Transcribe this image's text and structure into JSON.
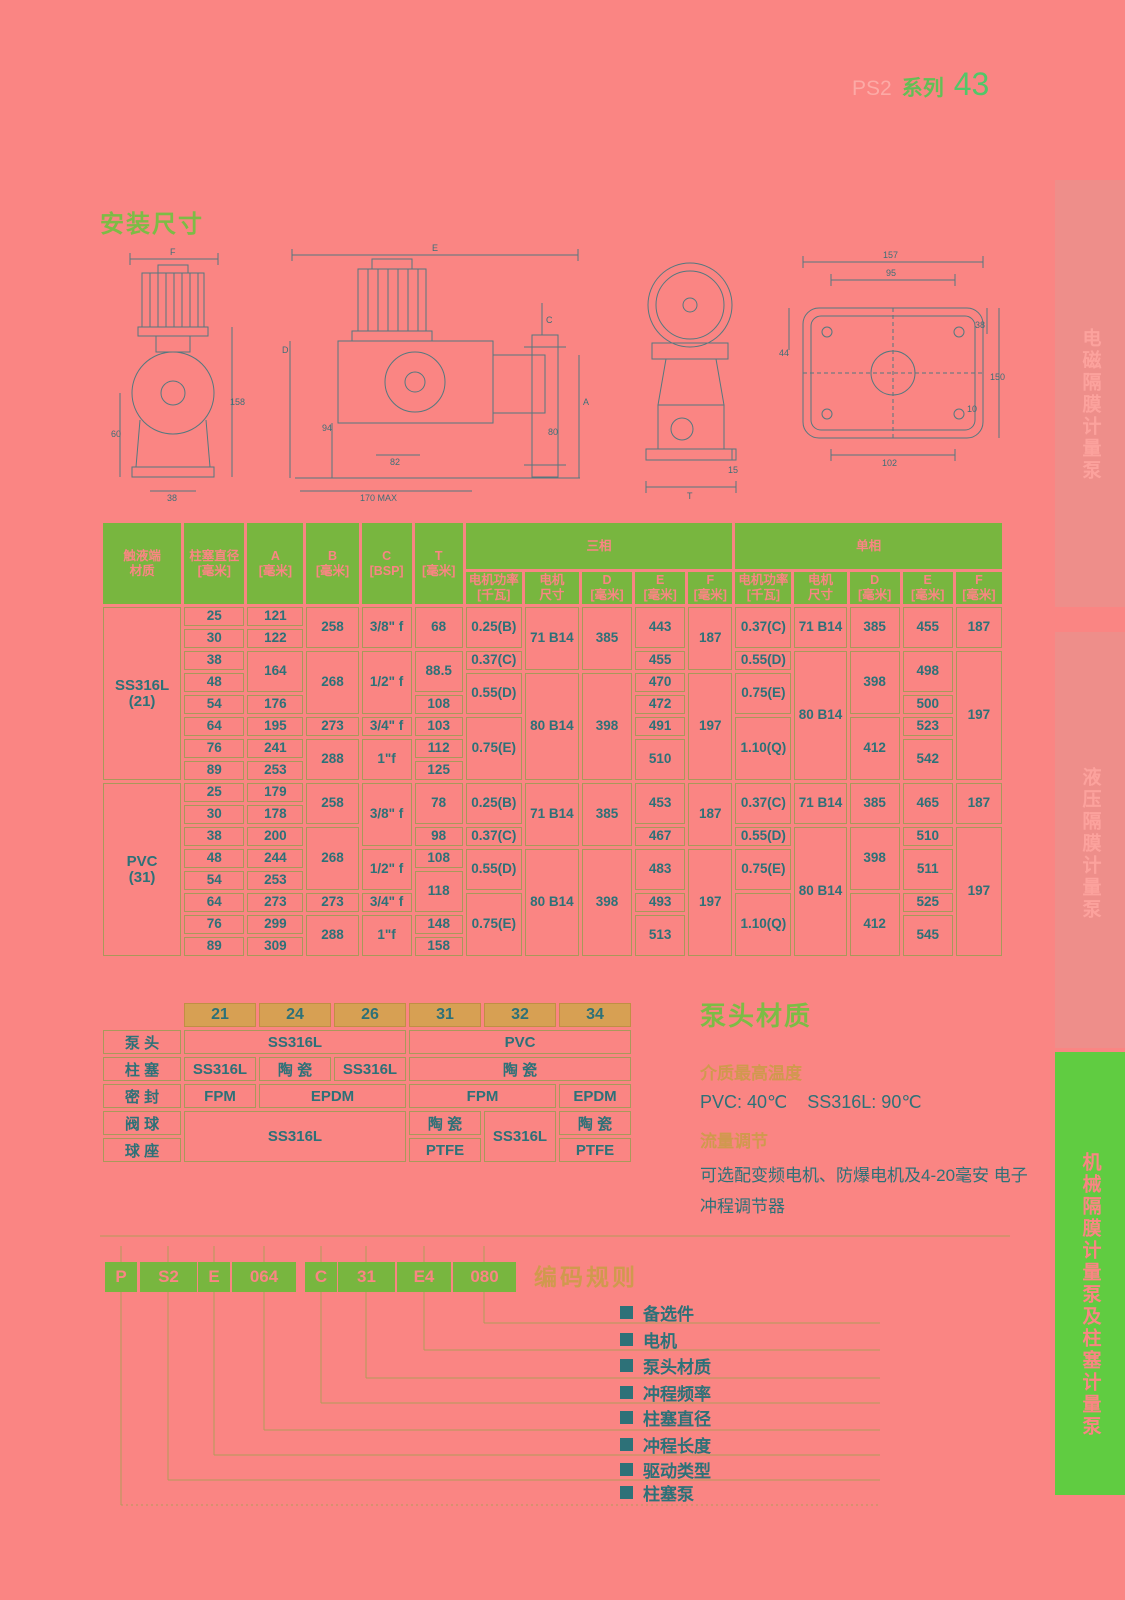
{
  "header": {
    "series_prefix": "PS2",
    "series_label": "系列",
    "page_number": "43"
  },
  "install": {
    "title": "安装尺寸"
  },
  "drawings": {
    "d1": {
      "f": "F",
      "n60": "60",
      "n158": "158",
      "n38": "38"
    },
    "d2": {
      "e": "E",
      "c": "C",
      "d": "D",
      "n94": "94",
      "n82": "82",
      "n170": "170 MAX",
      "a": "A",
      "n80": "80"
    },
    "d3": {
      "t": "T",
      "n15": "15"
    },
    "d4": {
      "n157": "157",
      "n95": "95",
      "n38": "38",
      "n44": "44",
      "n150": "150",
      "n10": "10",
      "n102": "102"
    }
  },
  "dim_table": {
    "header": [
      [
        {
          "t": "触液端\n材质",
          "rs": 2
        },
        {
          "t": "柱塞直径\n[毫米]",
          "rs": 2
        },
        {
          "t": "A\n[毫米]",
          "rs": 2
        },
        {
          "t": "B\n[毫米]",
          "rs": 2
        },
        {
          "t": "C\n[BSP]",
          "rs": 2
        },
        {
          "t": "T\n[毫米]",
          "rs": 2
        },
        {
          "t": "三相",
          "cs": 5
        },
        {
          "t": "单相",
          "cs": 5
        }
      ],
      [
        {
          "t": "电机功率\n[千瓦]"
        },
        {
          "t": "电机\n尺寸"
        },
        {
          "t": "D\n[毫米]"
        },
        {
          "t": "E\n[毫米]"
        },
        {
          "t": "F\n[毫米]"
        },
        {
          "t": "电机功率\n[千瓦]"
        },
        {
          "t": "电机\n尺寸"
        },
        {
          "t": "D\n[毫米]"
        },
        {
          "t": "E\n[毫米]"
        },
        {
          "t": "F\n[毫米]"
        }
      ]
    ],
    "rows": [
      [
        {
          "t": "SS316L\n(21)",
          "rs": 8,
          "cls": "mat"
        },
        {
          "t": "25"
        },
        {
          "t": "121"
        },
        {
          "t": "258",
          "rs": 2
        },
        {
          "t": "3/8\" f",
          "rs": 2
        },
        {
          "t": "68",
          "rs": 2
        },
        {
          "t": "0.25(B)",
          "rs": 2
        },
        {
          "t": "71 B14",
          "rs": 3
        },
        {
          "t": "385",
          "rs": 3
        },
        {
          "t": "443",
          "rs": 2
        },
        {
          "t": "187",
          "rs": 3
        },
        {
          "t": "0.37(C)",
          "rs": 2
        },
        {
          "t": "71 B14",
          "rs": 2
        },
        {
          "t": "385",
          "rs": 2
        },
        {
          "t": "455",
          "rs": 2
        },
        {
          "t": "187",
          "rs": 2
        }
      ],
      [
        {
          "t": "30"
        },
        {
          "t": "122"
        }
      ],
      [
        {
          "t": "38"
        },
        {
          "t": "164",
          "rs": 2
        },
        {
          "t": "268",
          "rs": 3
        },
        {
          "t": "1/2\" f",
          "rs": 3
        },
        {
          "t": "88.5",
          "rs": 2
        },
        {
          "t": "0.37(C)"
        },
        {
          "t": "455"
        },
        {
          "t": "0.55(D)"
        },
        {
          "t": "80 B14",
          "rs": 6
        },
        {
          "t": "398",
          "rs": 3
        },
        {
          "t": "498",
          "rs": 2
        },
        {
          "t": "197",
          "rs": 6
        }
      ],
      [
        {
          "t": "48"
        },
        {
          "t": "0.55(D)",
          "rs": 2
        },
        {
          "t": "80 B14",
          "rs": 5
        },
        {
          "t": "398",
          "rs": 5
        },
        {
          "t": "470"
        },
        {
          "t": "197",
          "rs": 5
        },
        {
          "t": "0.75(E)",
          "rs": 2
        }
      ],
      [
        {
          "t": "54"
        },
        {
          "t": "176"
        },
        {
          "t": "108"
        },
        {
          "t": "472"
        },
        {
          "t": "500"
        }
      ],
      [
        {
          "t": "64"
        },
        {
          "t": "195"
        },
        {
          "t": "273"
        },
        {
          "t": "3/4\" f"
        },
        {
          "t": "103"
        },
        {
          "t": "0.75(E)",
          "rs": 3
        },
        {
          "t": "491"
        },
        {
          "t": "1.10(Q)",
          "rs": 3
        },
        {
          "t": "412",
          "rs": 3
        },
        {
          "t": "523"
        }
      ],
      [
        {
          "t": "76"
        },
        {
          "t": "241"
        },
        {
          "t": "288",
          "rs": 2
        },
        {
          "t": "1\"f",
          "rs": 2
        },
        {
          "t": "112"
        },
        {
          "t": "510",
          "rs": 2
        },
        {
          "t": "542",
          "rs": 2
        }
      ],
      [
        {
          "t": "89"
        },
        {
          "t": "253"
        },
        {
          "t": "125"
        }
      ],
      [
        {
          "t": "PVC\n(31)",
          "rs": 8,
          "cls": "mat"
        },
        {
          "t": "25"
        },
        {
          "t": "179"
        },
        {
          "t": "258",
          "rs": 2
        },
        {
          "t": "3/8\" f",
          "rs": 3
        },
        {
          "t": "78",
          "rs": 2
        },
        {
          "t": "0.25(B)",
          "rs": 2
        },
        {
          "t": "71 B14",
          "rs": 3
        },
        {
          "t": "385",
          "rs": 3
        },
        {
          "t": "453",
          "rs": 2
        },
        {
          "t": "187",
          "rs": 3
        },
        {
          "t": "0.37(C)",
          "rs": 2
        },
        {
          "t": "71 B14",
          "rs": 2
        },
        {
          "t": "385",
          "rs": 2
        },
        {
          "t": "465",
          "rs": 2
        },
        {
          "t": "187",
          "rs": 2
        }
      ],
      [
        {
          "t": "30"
        },
        {
          "t": "178"
        }
      ],
      [
        {
          "t": "38"
        },
        {
          "t": "200"
        },
        {
          "t": "268",
          "rs": 3
        },
        {
          "t": "98"
        },
        {
          "t": "0.37(C)"
        },
        {
          "t": "467"
        },
        {
          "t": "0.55(D)"
        },
        {
          "t": "80 B14",
          "rs": 6
        },
        {
          "t": "398",
          "rs": 3
        },
        {
          "t": "510"
        },
        {
          "t": "197",
          "rs": 6
        }
      ],
      [
        {
          "t": "48"
        },
        {
          "t": "244"
        },
        {
          "t": "1/2\" f",
          "rs": 2
        },
        {
          "t": "108"
        },
        {
          "t": "0.55(D)",
          "rs": 2
        },
        {
          "t": "80 B14",
          "rs": 5
        },
        {
          "t": "398",
          "rs": 5
        },
        {
          "t": "483",
          "rs": 2
        },
        {
          "t": "197",
          "rs": 5
        },
        {
          "t": "0.75(E)",
          "rs": 2
        },
        {
          "t": "511",
          "rs": 2
        }
      ],
      [
        {
          "t": "54"
        },
        {
          "t": "253"
        },
        {
          "t": "118",
          "rs": 2
        }
      ],
      [
        {
          "t": "64"
        },
        {
          "t": "273"
        },
        {
          "t": "273"
        },
        {
          "t": "3/4\" f"
        },
        {
          "t": "0.75(E)",
          "rs": 3
        },
        {
          "t": "493"
        },
        {
          "t": "1.10(Q)",
          "rs": 3
        },
        {
          "t": "412",
          "rs": 3
        },
        {
          "t": "525"
        }
      ],
      [
        {
          "t": "76"
        },
        {
          "t": "299"
        },
        {
          "t": "288",
          "rs": 2
        },
        {
          "t": "1\"f",
          "rs": 2
        },
        {
          "t": "148"
        },
        {
          "t": "513",
          "rs": 2
        },
        {
          "t": "545",
          "rs": 2
        }
      ],
      [
        {
          "t": "89"
        },
        {
          "t": "309"
        },
        {
          "t": "158"
        }
      ]
    ]
  },
  "material_table": {
    "rows": [
      [
        {
          "t": "",
          "cls": "blank"
        },
        {
          "t": "21",
          "cls": "code"
        },
        {
          "t": "24",
          "cls": "code"
        },
        {
          "t": "26",
          "cls": "code"
        },
        {
          "t": "31",
          "cls": "code"
        },
        {
          "t": "32",
          "cls": "code"
        },
        {
          "t": "34",
          "cls": "code"
        }
      ],
      [
        {
          "t": "泵 头"
        },
        {
          "t": "SS316L",
          "cs": 3
        },
        {
          "t": "PVC",
          "cs": 3
        }
      ],
      [
        {
          "t": "柱 塞"
        },
        {
          "t": "SS316L"
        },
        {
          "t": "陶 瓷"
        },
        {
          "t": "SS316L"
        },
        {
          "t": "陶 瓷",
          "cs": 3
        }
      ],
      [
        {
          "t": "密 封"
        },
        {
          "t": "FPM"
        },
        {
          "t": "EPDM",
          "cs": 2
        },
        {
          "t": "FPM",
          "cs": 2
        },
        {
          "t": "EPDM"
        }
      ],
      [
        {
          "t": "阀 球"
        },
        {
          "t": "SS316L",
          "cs": 3,
          "rs": 2
        },
        {
          "t": "陶 瓷"
        },
        {
          "t": "SS316L",
          "rs": 2
        },
        {
          "t": "陶 瓷"
        }
      ],
      [
        {
          "t": "球 座"
        },
        {
          "t": "PTFE"
        },
        {
          "t": "PTFE"
        }
      ]
    ]
  },
  "pump_head": {
    "title": "泵头材质",
    "temp_heading": "介质最高温度",
    "temp_values": "PVC: 40℃    SS316L: 90℃",
    "flow_heading": "流量调节",
    "flow_text": "可选配变频电机、防爆电机及4-20毫安 电子冲程调节器"
  },
  "coding": {
    "title": "编码规则",
    "blocks": [
      "P",
      "S2",
      "E",
      "064",
      "C",
      "31",
      "E4",
      "080"
    ],
    "items": [
      "备选件",
      "电机",
      "泵头材质",
      "冲程频率",
      "柱塞直径",
      "冲程长度",
      "驱动类型",
      "柱塞泵"
    ]
  },
  "sidebar": {
    "tabs": [
      {
        "label": "电磁隔膜计量泵"
      },
      {
        "label": "液压隔膜计量泵"
      },
      {
        "label": "机械隔膜计量泵及柱塞计量泵"
      }
    ]
  }
}
